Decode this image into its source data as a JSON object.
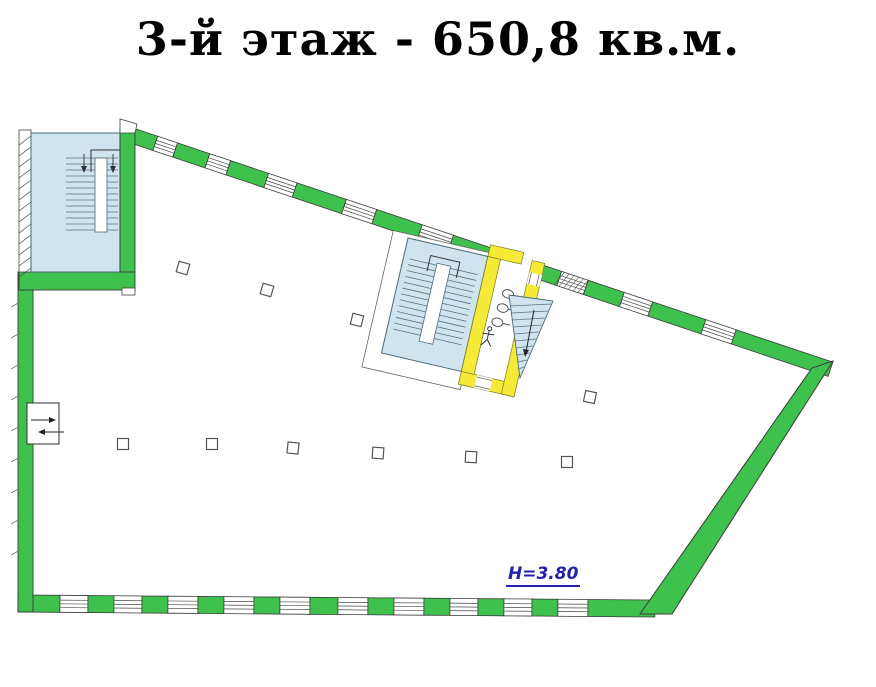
{
  "title": {
    "text": "3-й этаж - 650,8 кв.м."
  },
  "plan": {
    "ceiling_height_label": "H=3.80"
  },
  "colors": {
    "wall_green": "#3ec24d",
    "wall_yellow": "#f5ea38",
    "stair_blue": "#cfe4ee",
    "stair_line": "#58747f",
    "stair_edge": "#4a6a7a",
    "outline_dark": "#3a3a3a",
    "height_label_blue": "#2222aa",
    "title_black": "#000000"
  }
}
